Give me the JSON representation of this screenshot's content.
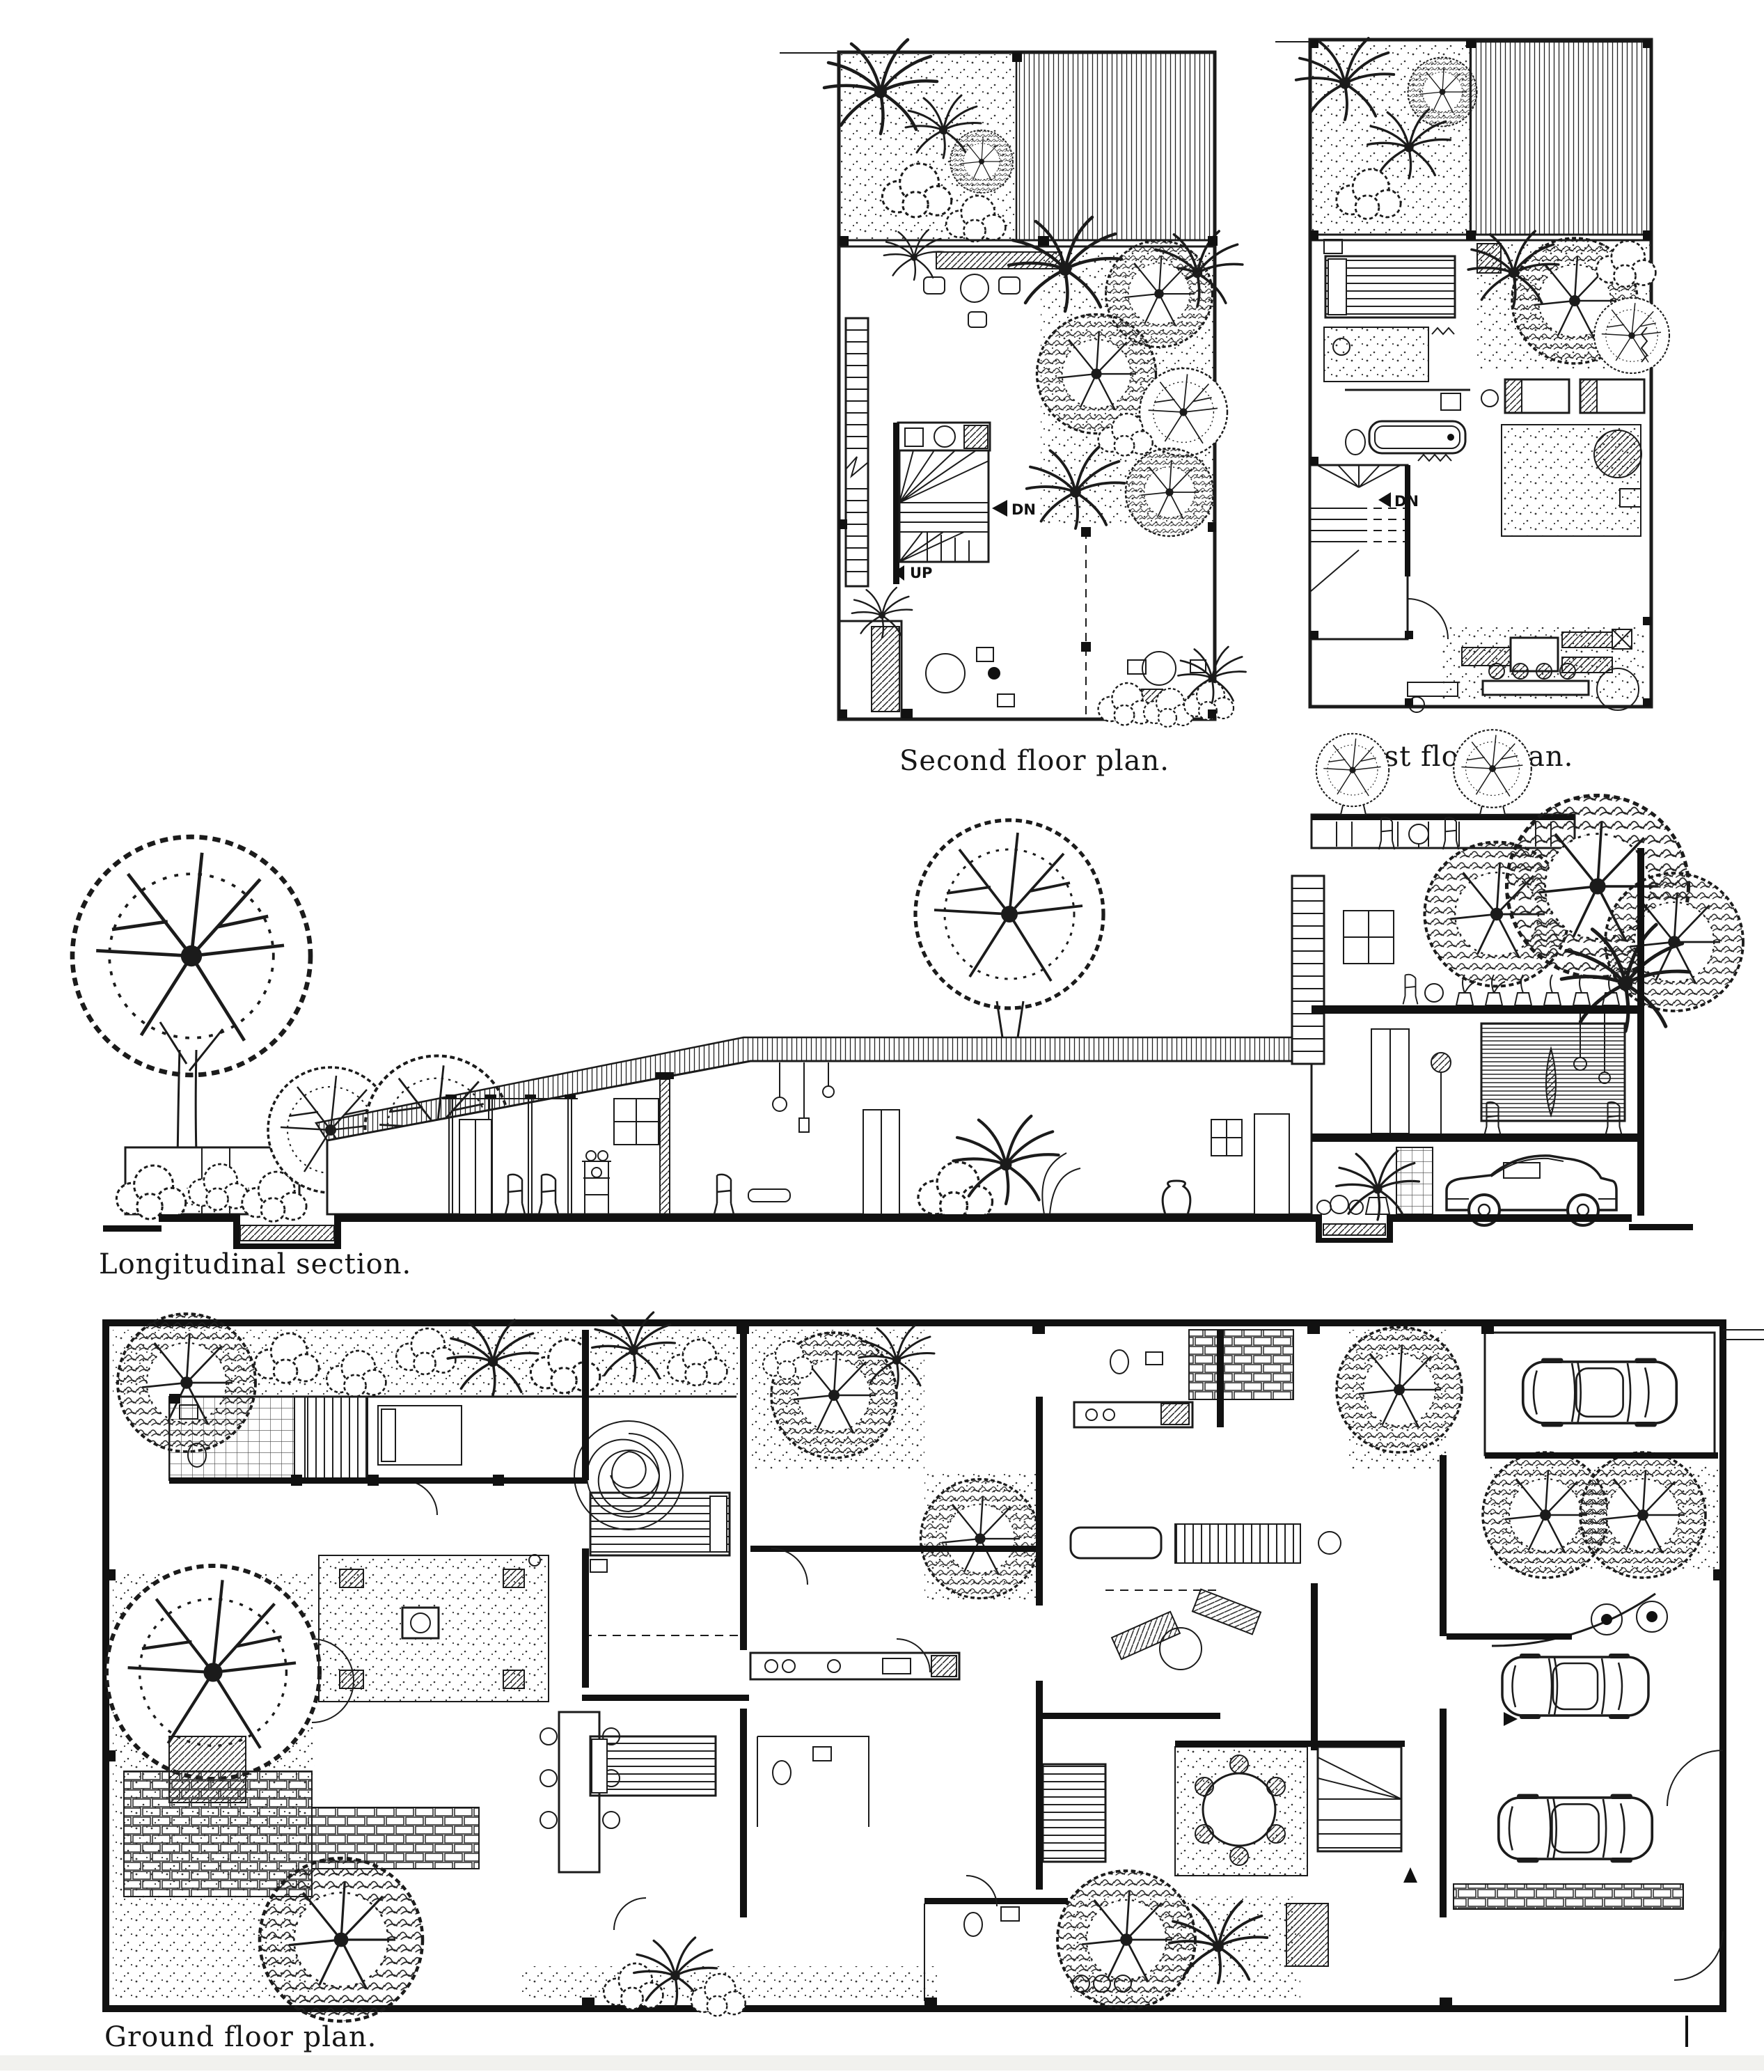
{
  "page": {
    "background": "#ffffff",
    "ink": "#1b1b1b",
    "artifact_band_color": "#f1f1ee"
  },
  "figures": {
    "second_floor": {
      "caption": "Second floor plan.",
      "stair_labels": {
        "up": "UP",
        "dn": "DN"
      }
    },
    "first_floor": {
      "caption": "First floor plan.",
      "stair_labels": {
        "dn": "DN"
      }
    },
    "section": {
      "caption": "Longitudinal section."
    },
    "ground_floor": {
      "caption": "Ground floor plan."
    }
  }
}
